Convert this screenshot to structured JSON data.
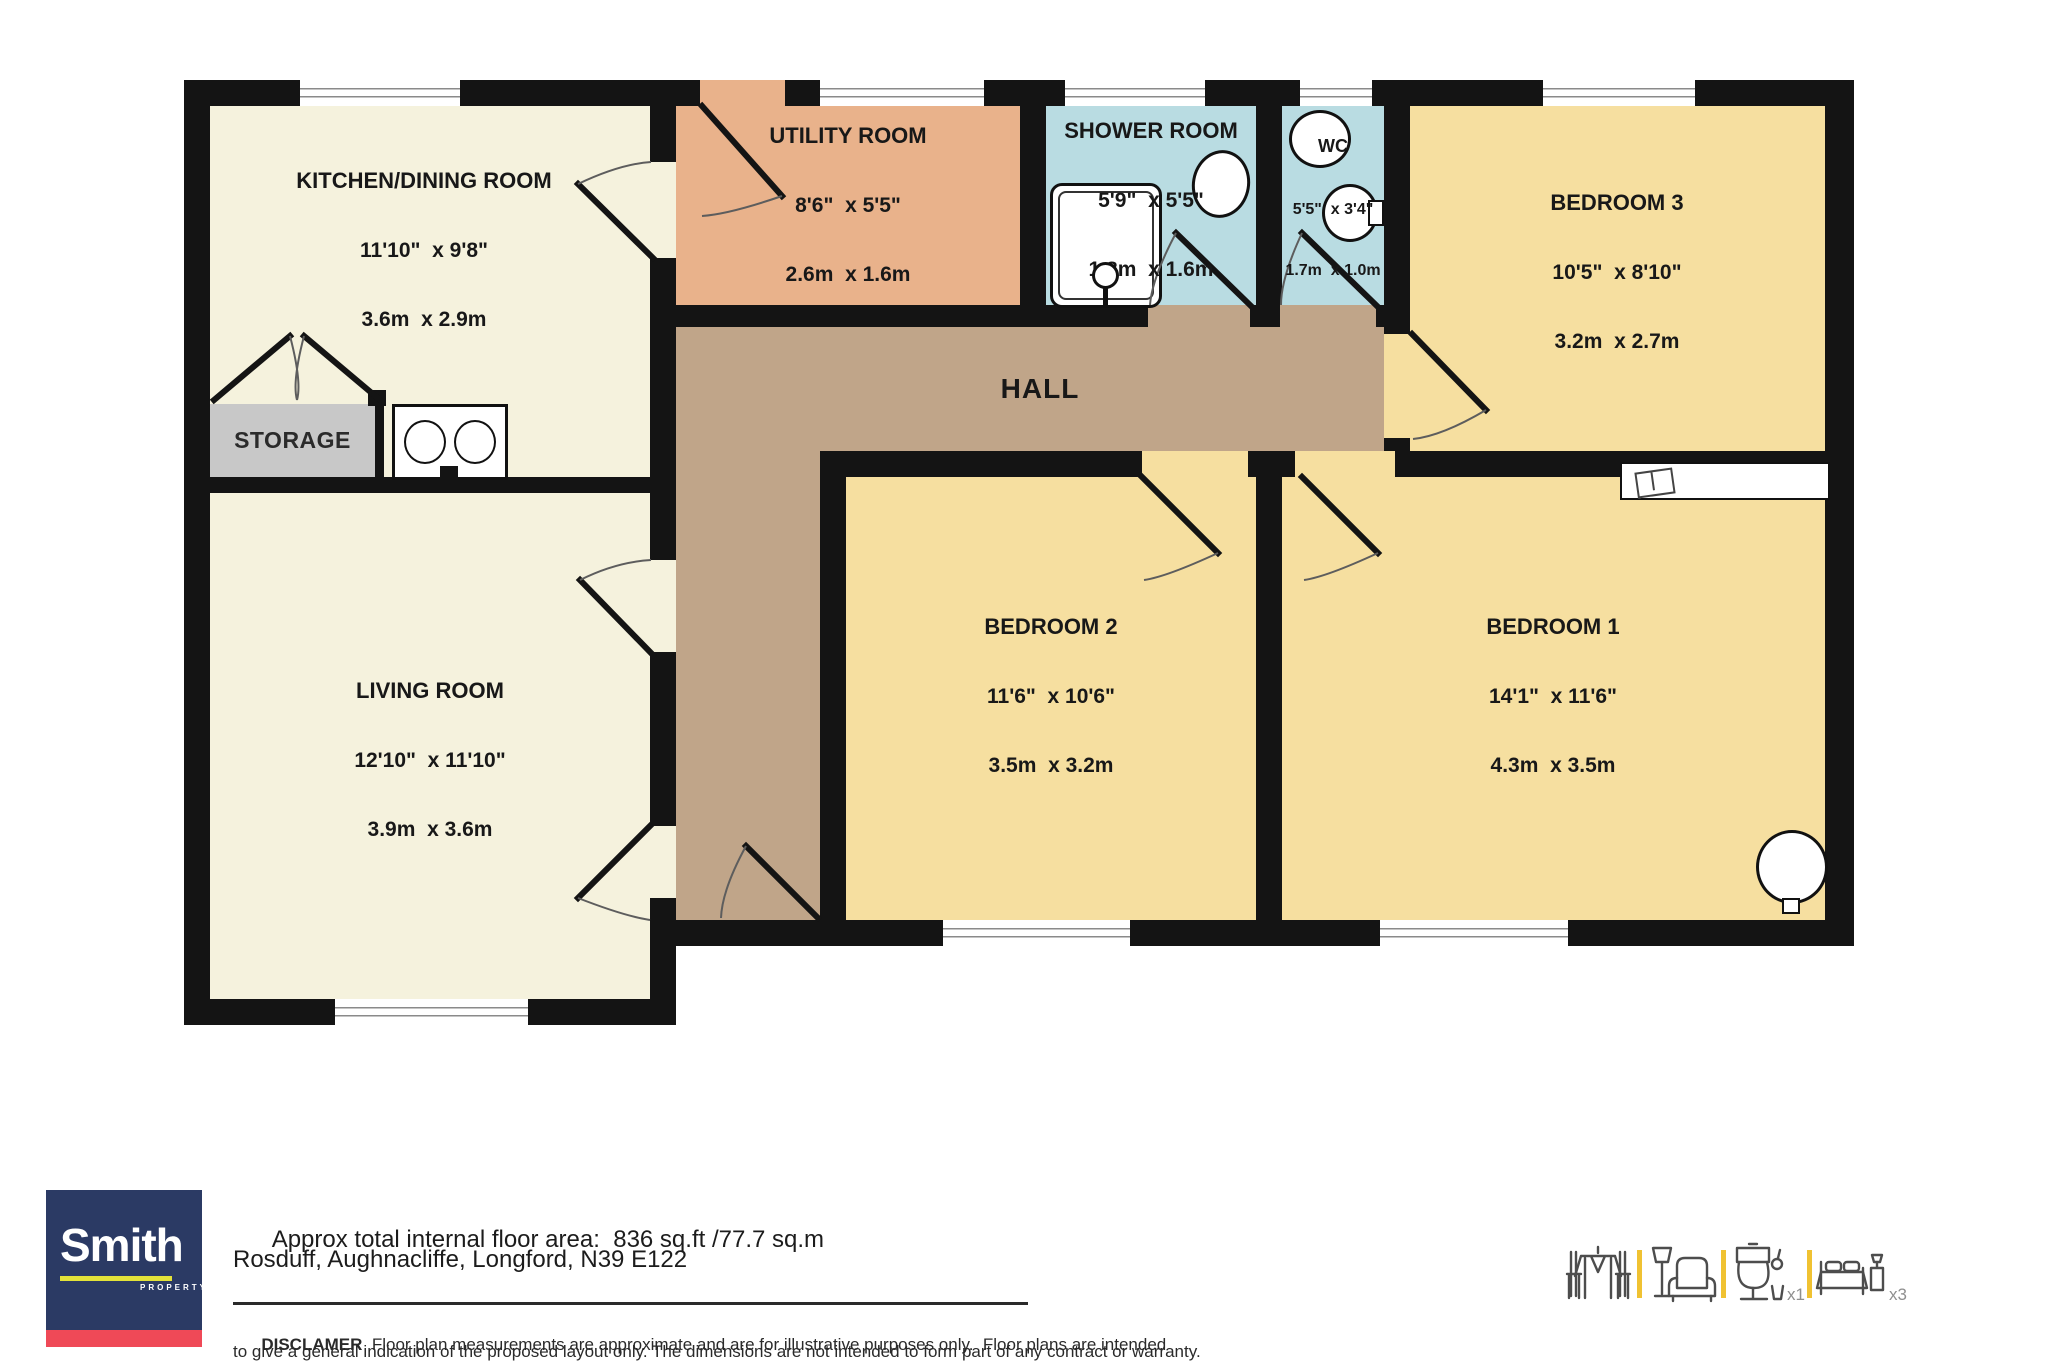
{
  "plan": {
    "rooms": {
      "kitchen": {
        "name": "KITCHEN/DINING ROOM",
        "imperial": "11'10\"  x 9'8\"",
        "metric": "3.6m  x 2.9m"
      },
      "utility": {
        "name": "UTILITY ROOM",
        "imperial": "8'6\"  x 5'5\"",
        "metric": "2.6m  x 1.6m"
      },
      "shower": {
        "name": "SHOWER ROOM",
        "imperial": "5'9\"  x 5'5\"",
        "metric": "1.8m  x 1.6m"
      },
      "wc": {
        "name": "WC",
        "imperial": "5'5\"  x 3'4\"",
        "metric": "1.7m  x 1.0m"
      },
      "bed3": {
        "name": "BEDROOM 3",
        "imperial": "10'5\"  x 8'10\"",
        "metric": "3.2m  x 2.7m"
      },
      "bed2": {
        "name": "BEDROOM 2",
        "imperial": "11'6\"  x 10'6\"",
        "metric": "3.5m  x 3.2m"
      },
      "bed1": {
        "name": "BEDROOM 1",
        "imperial": "14'1\"  x 11'6\"",
        "metric": "4.3m  x 3.5m"
      },
      "living": {
        "name": "LIVING ROOM",
        "imperial": "12'10\"  x 11'10\"",
        "metric": "3.9m  x 3.6m"
      },
      "hall": {
        "name": "HALL"
      },
      "storage": {
        "name": "STORAGE"
      }
    },
    "colors": {
      "wall": "#141414",
      "cream_room": "#f5f2dd",
      "bedroom_yellow": "#f6dfa0",
      "wet_room_blue": "#b9dce2",
      "utility_orange": "#e9b28b",
      "hall_tan": "#c0a589",
      "storage_grey": "#c8c8c8"
    }
  },
  "footer": {
    "brand": "Smith",
    "brand_sub": "PROPERTY",
    "brand_navy": "#2b3a64",
    "brand_red": "#ef4957",
    "brand_yellow": "#e3e239",
    "area_label": "Approx total internal floor area:",
    "area_value": "836 sq.ft /77.7 sq.m",
    "address": "Rosduff, Aughnacliffe, Longford, N39 E122",
    "disclaimer_label": "DISCLAMER",
    "disclaimer_line1": "  Floor plan measurements are approximate and are for illustrative purposes only.  Floor plans are intended",
    "disclaimer_line2": "to give a general indication of the proposed layout only. The dimensions are not intended to form part of any contract or warranty."
  },
  "legend": {
    "toilet_count": "x1",
    "bed_count": "x3",
    "divider_yellow": "#f0c232",
    "icons": [
      "dining-table-icon",
      "lamp-armchair-icon",
      "toilet-icon",
      "bed-icon"
    ]
  }
}
